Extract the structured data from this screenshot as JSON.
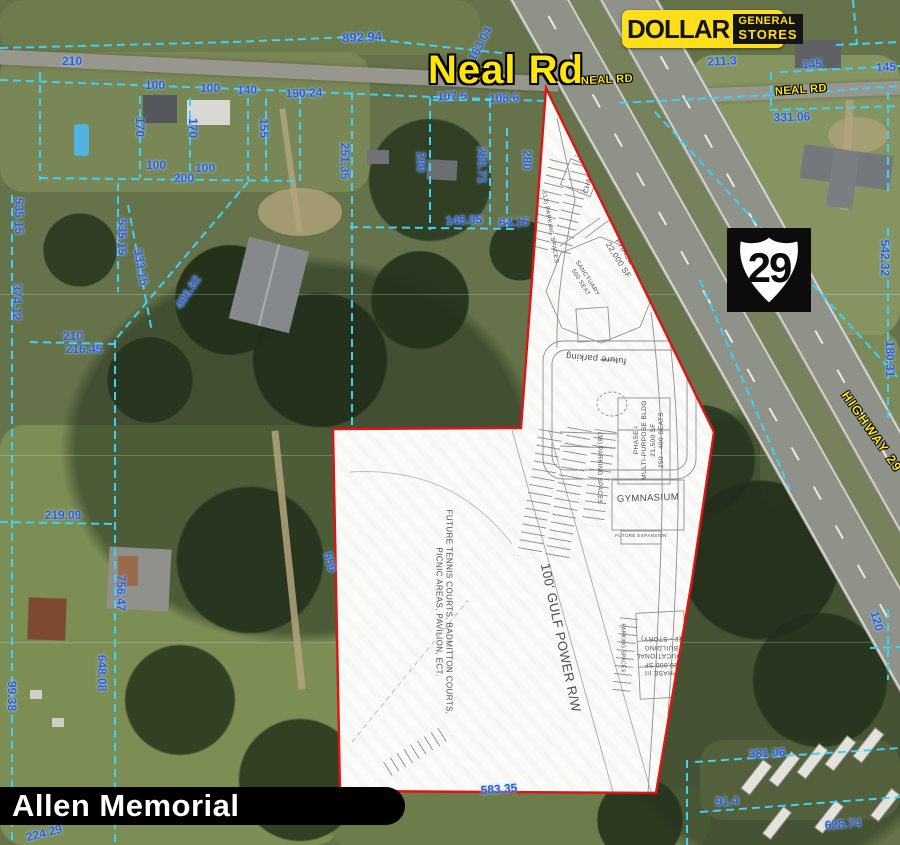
{
  "map": {
    "big_road_label": "Neal Rd",
    "road_small_labels": [
      {
        "text": "NEAL RD",
        "x": 607,
        "y": 80,
        "rot": -3
      },
      {
        "text": "NEAL RD",
        "x": 801,
        "y": 90,
        "rot": -4
      }
    ],
    "highway_label": {
      "text": "HIGHWAY 29"
    },
    "shield": {
      "number": "29"
    },
    "logo": {
      "word1": "DOLLAR",
      "word2": "GENERAL",
      "word3": "STORES"
    },
    "title_bar": {
      "text": "Allen Memorial"
    },
    "colors": {
      "parcel_line": "#3fd0f8",
      "parcel_text": "#3558cf",
      "boundary": "#df1414",
      "road_label": "#ffe60a"
    }
  },
  "parcel_labels": [
    {
      "text": "210",
      "x": 72,
      "y": 61
    },
    {
      "text": "892.94",
      "x": 362,
      "y": 37,
      "rot": -3,
      "size": 13
    },
    {
      "text": "163.04",
      "x": 480,
      "y": 44,
      "rot": -62
    },
    {
      "text": "100",
      "x": 155,
      "y": 85
    },
    {
      "text": "100",
      "x": 210,
      "y": 88
    },
    {
      "text": "140",
      "x": 247,
      "y": 90
    },
    {
      "text": "190.24",
      "x": 304,
      "y": 93,
      "rot": -2
    },
    {
      "text": "107.5",
      "x": 452,
      "y": 96,
      "rot": -2
    },
    {
      "text": "108.6",
      "x": 504,
      "y": 98,
      "rot": -2
    },
    {
      "text": "211.3",
      "x": 722,
      "y": 61,
      "rot": -3
    },
    {
      "text": "145",
      "x": 812,
      "y": 64,
      "rot": -3
    },
    {
      "text": "145",
      "x": 886,
      "y": 67,
      "rot": -3
    },
    {
      "text": "331.06",
      "x": 792,
      "y": 117,
      "rot": -2
    },
    {
      "text": "170",
      "x": 140,
      "y": 127,
      "rot": 90
    },
    {
      "text": "170",
      "x": 193,
      "y": 128,
      "rot": 90
    },
    {
      "text": "155",
      "x": 264,
      "y": 128,
      "rot": 90
    },
    {
      "text": "100",
      "x": 156,
      "y": 165
    },
    {
      "text": "100",
      "x": 205,
      "y": 168
    },
    {
      "text": "200",
      "x": 184,
      "y": 178
    },
    {
      "text": "251.35",
      "x": 345,
      "y": 161,
      "rot": 90
    },
    {
      "text": "280",
      "x": 421,
      "y": 162,
      "rot": 90
    },
    {
      "text": "285.71",
      "x": 482,
      "y": 165,
      "rot": 90
    },
    {
      "text": "280",
      "x": 527,
      "y": 160,
      "rot": 90
    },
    {
      "text": "145.85",
      "x": 464,
      "y": 220,
      "rot": -2
    },
    {
      "text": "64.15",
      "x": 514,
      "y": 222,
      "rot": -2
    },
    {
      "text": "535.15",
      "x": 19,
      "y": 216,
      "rot": 90
    },
    {
      "text": "535.15",
      "x": 122,
      "y": 237,
      "rot": 90
    },
    {
      "text": "333.15",
      "x": 141,
      "y": 267,
      "rot": 80
    },
    {
      "text": "406.82",
      "x": 188,
      "y": 292,
      "rot": -57
    },
    {
      "text": "374.12",
      "x": 17,
      "y": 302,
      "rot": 90
    },
    {
      "text": "542.32",
      "x": 885,
      "y": 258,
      "rot": 90
    },
    {
      "text": "180.31",
      "x": 890,
      "y": 359,
      "rot": 90
    },
    {
      "text": "210",
      "x": 73,
      "y": 336
    },
    {
      "text": "216.45",
      "x": 84,
      "y": 349
    },
    {
      "text": "219.09",
      "x": 63,
      "y": 515
    },
    {
      "text": "559",
      "x": 330,
      "y": 562,
      "rot": 75
    },
    {
      "text": "756.47",
      "x": 121,
      "y": 593,
      "rot": 90
    },
    {
      "text": "648.08",
      "x": 102,
      "y": 673,
      "rot": 90
    },
    {
      "text": "99.38",
      "x": 12,
      "y": 696,
      "rot": 90
    },
    {
      "text": "120",
      "x": 877,
      "y": 621,
      "rot": 75
    },
    {
      "text": "381.06",
      "x": 767,
      "y": 753,
      "rot": -3
    },
    {
      "text": "91.4",
      "x": 727,
      "y": 801,
      "rot": -3
    },
    {
      "text": "628.74",
      "x": 843,
      "y": 824,
      "rot": -4
    },
    {
      "text": "583.35",
      "x": 499,
      "y": 789,
      "rot": -4
    },
    {
      "text": "224.29",
      "x": 44,
      "y": 833,
      "rot": -14
    }
  ],
  "parcel_lines": [
    [
      0,
      48,
      233,
      42
    ],
    [
      233,
      42,
      352,
      37
    ],
    [
      352,
      37,
      520,
      55
    ],
    [
      0,
      80,
      240,
      89
    ],
    [
      240,
      89,
      433,
      97
    ],
    [
      433,
      97,
      545,
      101
    ],
    [
      433,
      100,
      517,
      100
    ],
    [
      40,
      72,
      40,
      180
    ],
    [
      140,
      96,
      140,
      178
    ],
    [
      190,
      98,
      190,
      179
    ],
    [
      248,
      98,
      248,
      180
    ],
    [
      266,
      98,
      266,
      180
    ],
    [
      300,
      96,
      300,
      181
    ],
    [
      40,
      178,
      300,
      181
    ],
    [
      352,
      92,
      352,
      428
    ],
    [
      430,
      98,
      430,
      230
    ],
    [
      490,
      100,
      490,
      227
    ],
    [
      507,
      128,
      507,
      227
    ],
    [
      350,
      227,
      518,
      229
    ],
    [
      12,
      195,
      12,
      845
    ],
    [
      118,
      183,
      118,
      292
    ],
    [
      128,
      205,
      152,
      332
    ],
    [
      248,
      182,
      115,
      340
    ],
    [
      115,
      340,
      115,
      845
    ],
    [
      30,
      342,
      115,
      344
    ],
    [
      0,
      522,
      115,
      524
    ],
    [
      620,
      103,
      772,
      95
    ],
    [
      772,
      95,
      900,
      86
    ],
    [
      780,
      72,
      900,
      66
    ],
    [
      771,
      72,
      771,
      110
    ],
    [
      770,
      110,
      900,
      106
    ],
    [
      888,
      92,
      888,
      196
    ],
    [
      888,
      228,
      888,
      420
    ],
    [
      655,
      112,
      900,
      380
    ],
    [
      700,
      280,
      790,
      490
    ],
    [
      695,
      762,
      900,
      748
    ],
    [
      700,
      812,
      900,
      797
    ],
    [
      687,
      760,
      687,
      845
    ],
    [
      888,
      610,
      888,
      680
    ],
    [
      870,
      648,
      900,
      647
    ],
    [
      853,
      0,
      857,
      45
    ],
    [
      836,
      45,
      900,
      42
    ]
  ],
  "site_plan": {
    "labels": [
      {
        "text": "CHAPEL",
        "x": 590,
        "y": 179,
        "rot": -75,
        "size": 7
      },
      {
        "text": "PHASE II\n22,000 SF",
        "x": 622,
        "y": 258,
        "rot": 58,
        "size": 8
      },
      {
        "text": "SANCTUARY\n500 SEAT",
        "x": 583,
        "y": 281,
        "rot": 58,
        "size": 6
      },
      {
        "text": "(13) PARKING SPACES",
        "x": 549,
        "y": 228,
        "rot": 80,
        "size": 6
      },
      {
        "text": "future parking",
        "x": 596,
        "y": 358,
        "rot": 185,
        "size": 9
      },
      {
        "text": "PHASE I\nMULTI-PURPOSE BLDG\n21,500 SF\n250 - 400 SEATS",
        "x": 650,
        "y": 440,
        "rot": -90,
        "size": 6.5
      },
      {
        "text": "(36) PARKING SPACES",
        "x": 598,
        "y": 468,
        "rot": 90,
        "size": 6
      },
      {
        "text": "GYMNASIUM",
        "x": 648,
        "y": 499,
        "rot": -2,
        "size": 9.5
      },
      {
        "text": "FUTURE EXPANSION",
        "x": 641,
        "y": 536,
        "rot": 0,
        "size": 4.5
      },
      {
        "text": "100' GULF POWER R/W",
        "x": 560,
        "y": 638,
        "rot": 78,
        "size": 13
      },
      {
        "text": "FUTURE TENNIS COURTS, BADMITTON COURTS,\nPICNIC AREAS, PAVILION, ECT.",
        "x": 443,
        "y": 612,
        "rot": 90,
        "size": 8
      },
      {
        "text": "PARKING SPACES",
        "x": 622,
        "y": 648,
        "rot": 90,
        "size": 5
      },
      {
        "text": "PHASE III\n20,000 SF\nEDUCATIONAL\nBUILDING\n(2 - STORY)",
        "x": 661,
        "y": 655,
        "rot": 180,
        "size": 6.5
      }
    ]
  }
}
